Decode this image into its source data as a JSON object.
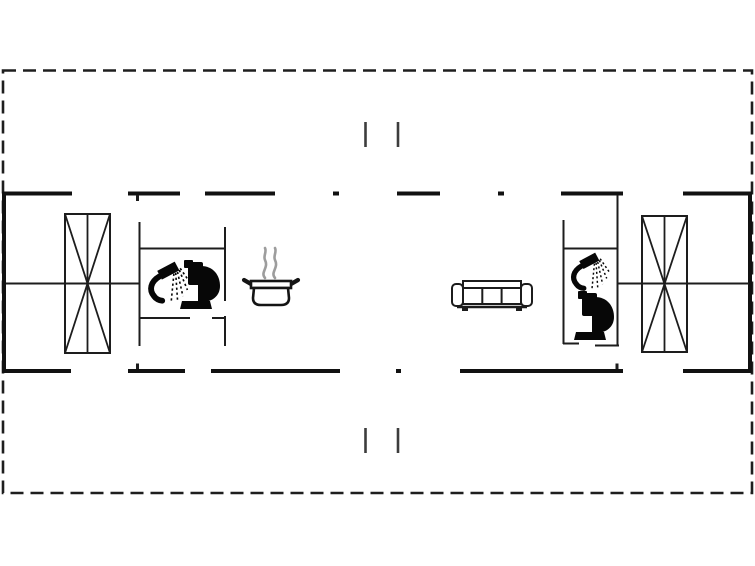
{
  "plan": {
    "canvas": {
      "width": 755,
      "height": 566,
      "background": "#ffffff"
    },
    "colors": {
      "wall": "#111111",
      "interior_wall": "#1d1d1d",
      "boundary": "#1e1e1e",
      "section_mark": "#3d3d3d",
      "icon": "#070707",
      "steam": "#9d9d9d",
      "fixture_fill": "#ffffff"
    },
    "boundary": {
      "x": 3,
      "y": 70.5,
      "w": 749,
      "h": 422.5,
      "dash": [
        13,
        7
      ],
      "stroke_width": 2.6
    },
    "section_marks": [
      {
        "x": 365.5,
        "y1": 122,
        "y2": 147
      },
      {
        "x": 398,
        "y1": 122,
        "y2": 147
      },
      {
        "x": 365.5,
        "y1": 428,
        "y2": 453
      },
      {
        "x": 398,
        "y1": 428,
        "y2": 453
      }
    ],
    "walls_thick": [
      {
        "x1": 2,
        "y1": 193.5,
        "x2": 72,
        "y2": 193.5
      },
      {
        "x1": 128,
        "y1": 193.5,
        "x2": 180,
        "y2": 193.5
      },
      {
        "x1": 205,
        "y1": 193.5,
        "x2": 275,
        "y2": 193.5
      },
      {
        "x1": 333,
        "y1": 193.5,
        "x2": 339,
        "y2": 193.5
      },
      {
        "x1": 397,
        "y1": 193.5,
        "x2": 440,
        "y2": 193.5
      },
      {
        "x1": 498,
        "y1": 193.5,
        "x2": 504,
        "y2": 193.5
      },
      {
        "x1": 561,
        "y1": 193.5,
        "x2": 623,
        "y2": 193.5
      },
      {
        "x1": 683,
        "y1": 193.5,
        "x2": 752,
        "y2": 193.5
      },
      {
        "x1": 2,
        "y1": 371,
        "x2": 71,
        "y2": 371
      },
      {
        "x1": 128,
        "y1": 371,
        "x2": 185,
        "y2": 371
      },
      {
        "x1": 211,
        "y1": 371,
        "x2": 340,
        "y2": 371
      },
      {
        "x1": 396,
        "y1": 371,
        "x2": 401,
        "y2": 371
      },
      {
        "x1": 460,
        "y1": 371,
        "x2": 623,
        "y2": 371
      },
      {
        "x1": 683,
        "y1": 371,
        "x2": 752,
        "y2": 371
      },
      {
        "x1": 4,
        "y1": 191.5,
        "x2": 4,
        "y2": 373
      },
      {
        "x1": 750,
        "y1": 191.5,
        "x2": 750,
        "y2": 373
      }
    ],
    "walls_thin": [
      {
        "x1": 6,
        "y1": 283.5,
        "x2": 139,
        "y2": 283.5
      },
      {
        "x1": 617,
        "y1": 283.5,
        "x2": 749,
        "y2": 283.5
      },
      {
        "x1": 139.5,
        "y1": 222,
        "x2": 139.5,
        "y2": 346
      },
      {
        "x1": 139,
        "y1": 248.5,
        "x2": 226,
        "y2": 248.5
      },
      {
        "x1": 225,
        "y1": 227,
        "x2": 225,
        "y2": 301
      },
      {
        "x1": 225,
        "y1": 316,
        "x2": 225,
        "y2": 346
      },
      {
        "x1": 139,
        "y1": 318,
        "x2": 190,
        "y2": 318
      },
      {
        "x1": 212,
        "y1": 318,
        "x2": 226,
        "y2": 318
      },
      {
        "x1": 563.5,
        "y1": 220,
        "x2": 563.5,
        "y2": 344
      },
      {
        "x1": 563,
        "y1": 343.5,
        "x2": 579,
        "y2": 343.5
      },
      {
        "x1": 563,
        "y1": 248.5,
        "x2": 617,
        "y2": 248.5
      },
      {
        "x1": 617.5,
        "y1": 195,
        "x2": 617.5,
        "y2": 346
      },
      {
        "x1": 595,
        "y1": 345.5,
        "x2": 619,
        "y2": 345.5
      },
      {
        "x1": 137.5,
        "y1": 195,
        "x2": 137.5,
        "y2": 201,
        "w": 3
      },
      {
        "x1": 137.5,
        "y1": 363.5,
        "x2": 137.5,
        "y2": 369,
        "w": 3
      },
      {
        "x1": 617,
        "y1": 363.5,
        "x2": 617,
        "y2": 369,
        "w": 3
      }
    ],
    "wardrobe_boxes": [
      {
        "x": 65,
        "y": 214,
        "w": 45,
        "h": 139
      },
      {
        "x": 642,
        "y": 216,
        "w": 45,
        "h": 136
      }
    ],
    "furniture": {
      "shower_left": {
        "name": "shower",
        "x": 146,
        "y": 262,
        "scale": 0.9
      },
      "toilet_left": {
        "name": "toilet",
        "x": 177,
        "y": 259,
        "scale": 1
      },
      "stove_pot": {
        "name": "cooking-pot",
        "x": 242,
        "y": 247,
        "scale": 1
      },
      "sofa": {
        "name": "sofa",
        "x": 451,
        "y": 279,
        "scale": 1
      },
      "shower_right": {
        "name": "shower",
        "x": 569,
        "y": 253,
        "scale": 0.82
      },
      "toilet_right": {
        "name": "toilet",
        "x": 571,
        "y": 290,
        "scale": 1
      }
    }
  }
}
